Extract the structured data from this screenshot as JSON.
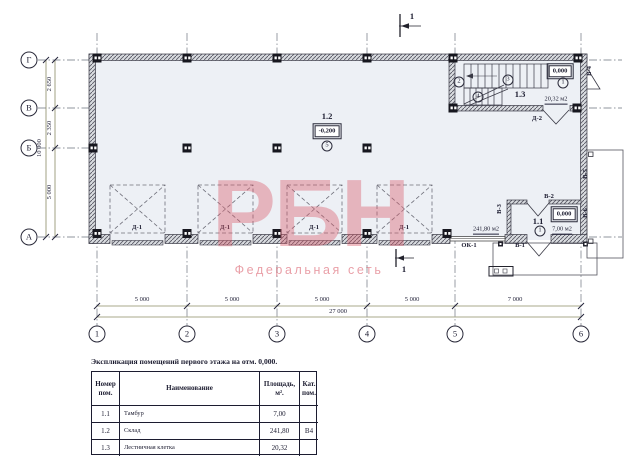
{
  "watermark": {
    "title": "РБН",
    "subtitle": "Федеральная сеть"
  },
  "section_marks": {
    "top": "1",
    "bottom": "1"
  },
  "axes": {
    "left": [
      "Г",
      "В",
      "Б",
      "А"
    ],
    "bottom": [
      "1",
      "2",
      "3",
      "4",
      "5",
      "6"
    ]
  },
  "dims": {
    "left": {
      "seg_gv": "2 650",
      "seg_vb": "2 350",
      "seg_ba": "5 000",
      "total": "10 000"
    },
    "bottom": {
      "seg_12": "5 000",
      "seg_23": "5 000",
      "seg_34": "5 000",
      "seg_45": "5 000",
      "seg_56": "7 000",
      "total": "27 000"
    }
  },
  "rooms": {
    "storage": {
      "number": "1.2",
      "elevation": "-0,200",
      "zone": "5",
      "area": "241,80 м2"
    },
    "stairwell": {
      "number": "1.3",
      "elevation": "0,000",
      "area": "20,32 м2",
      "zone_1": "1",
      "zone_2": "2",
      "zone_3": "3",
      "zone_4": "4"
    },
    "tambour": {
      "number": "1.1",
      "elevation": "0,000",
      "zone": "1",
      "area": "7,00 м2"
    }
  },
  "openings": {
    "gate_label": "Д-1",
    "stair_door": "Д-2",
    "entry_door": "В-1",
    "tambour_door": "В-2",
    "v3": "В-3",
    "exit_door": "В-4",
    "v5": "В-5",
    "v6": "В-6",
    "window": "ОК-1"
  },
  "legend": {
    "title": "Экспликация помещений первого этажа на отм. 0,000.",
    "headers": {
      "number": "Номер\nпом.",
      "name": "Наименование",
      "area": "Площадь,\nм².",
      "category": "Кат.\nпом."
    },
    "rows": [
      {
        "number": "1.1",
        "name": "Тамбур",
        "area": "7,00",
        "category": ""
      },
      {
        "number": "1.2",
        "name": "Склад",
        "area": "241,80",
        "category": "В4"
      },
      {
        "number": "1.3",
        "name": "Лестничная клетка",
        "area": "20,32",
        "category": ""
      }
    ]
  },
  "colors": {
    "interior_fill": "#edf0f5",
    "watermark_pink": "#d95a68",
    "dim_line": "#8b8b64"
  }
}
